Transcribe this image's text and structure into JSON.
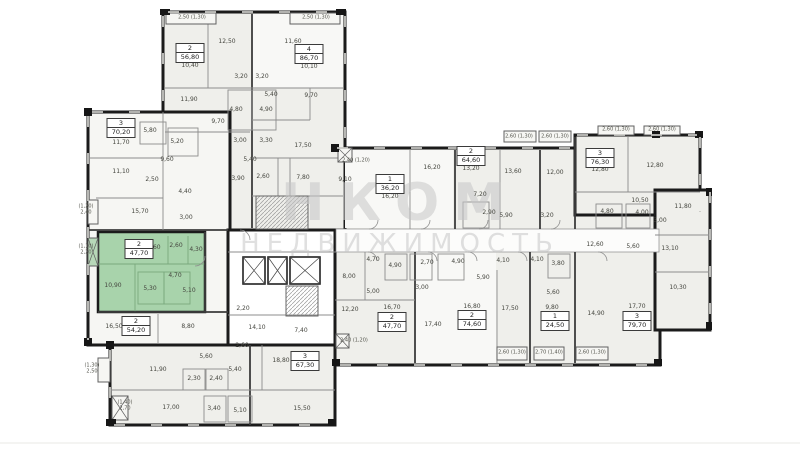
{
  "watermark": {
    "line1": "НКОМ",
    "line2": "НЕДВИЖИМОСТЬ"
  },
  "highlight_color": "#a8d3ab",
  "apartments": [
    {
      "t": "2",
      "a": "56,80",
      "x": 190,
      "y": 53
    },
    {
      "t": "4",
      "a": "86,70",
      "x": 309,
      "y": 54
    },
    {
      "t": "3",
      "a": "70,20",
      "x": 121,
      "y": 128
    },
    {
      "t": "2",
      "a": "47,70",
      "x": 139,
      "y": 249,
      "hl": true
    },
    {
      "t": "2",
      "a": "54,20",
      "x": 136,
      "y": 326
    },
    {
      "t": "1",
      "a": "36,20",
      "x": 390,
      "y": 184
    },
    {
      "t": "2",
      "a": "64,60",
      "x": 471,
      "y": 156
    },
    {
      "t": "3",
      "a": "76,30",
      "x": 600,
      "y": 158
    },
    {
      "t": "2",
      "a": "47,70",
      "x": 392,
      "y": 322
    },
    {
      "t": "2",
      "a": "74,60",
      "x": 472,
      "y": 320
    },
    {
      "t": "1",
      "a": "24,50",
      "x": 555,
      "y": 321
    },
    {
      "t": "3",
      "a": "79,70",
      "x": 637,
      "y": 321
    },
    {
      "t": "3",
      "a": "67,30",
      "x": 305,
      "y": 361
    }
  ],
  "rooms": [
    {
      "v": "12,50",
      "x": 227,
      "y": 42
    },
    {
      "v": "11,60",
      "x": 293,
      "y": 42
    },
    {
      "v": "10,40",
      "x": 190,
      "y": 66
    },
    {
      "v": "10,10",
      "x": 309,
      "y": 67
    },
    {
      "v": "3,20",
      "x": 241,
      "y": 77
    },
    {
      "v": "3,20",
      "x": 262,
      "y": 77
    },
    {
      "v": "11,90",
      "x": 189,
      "y": 100
    },
    {
      "v": "4,80",
      "x": 236,
      "y": 110
    },
    {
      "v": "4,90",
      "x": 266,
      "y": 110
    },
    {
      "v": "5,40",
      "x": 271,
      "y": 95
    },
    {
      "v": "9,70",
      "x": 311,
      "y": 96
    },
    {
      "v": "9,70",
      "x": 218,
      "y": 122
    },
    {
      "v": "3,00",
      "x": 240,
      "y": 141
    },
    {
      "v": "3,30",
      "x": 266,
      "y": 141
    },
    {
      "v": "17,50",
      "x": 303,
      "y": 146
    },
    {
      "v": "5,80",
      "x": 150,
      "y": 131
    },
    {
      "v": "5,20",
      "x": 177,
      "y": 142
    },
    {
      "v": "11,70",
      "x": 121,
      "y": 143
    },
    {
      "v": "9,60",
      "x": 167,
      "y": 160
    },
    {
      "v": "5,40",
      "x": 250,
      "y": 160
    },
    {
      "v": "11,10",
      "x": 121,
      "y": 172
    },
    {
      "v": "2,50",
      "x": 152,
      "y": 180
    },
    {
      "v": "3,90",
      "x": 238,
      "y": 179
    },
    {
      "v": "2,60",
      "x": 263,
      "y": 177
    },
    {
      "v": "7,80",
      "x": 303,
      "y": 178
    },
    {
      "v": "4,40",
      "x": 185,
      "y": 192
    },
    {
      "v": "15,70",
      "x": 140,
      "y": 212
    },
    {
      "v": "3,00",
      "x": 186,
      "y": 218
    },
    {
      "v": "13,60",
      "x": 152,
      "y": 248
    },
    {
      "v": "2,60",
      "x": 176,
      "y": 246
    },
    {
      "v": "4,30",
      "x": 196,
      "y": 250
    },
    {
      "v": "10,90",
      "x": 113,
      "y": 286
    },
    {
      "v": "5,30",
      "x": 150,
      "y": 289
    },
    {
      "v": "5,10",
      "x": 189,
      "y": 291
    },
    {
      "v": "4,70",
      "x": 175,
      "y": 276
    },
    {
      "v": "16,50",
      "x": 114,
      "y": 327
    },
    {
      "v": "8,80",
      "x": 188,
      "y": 327
    },
    {
      "v": "2,20",
      "x": 243,
      "y": 309
    },
    {
      "v": "14,10",
      "x": 257,
      "y": 328
    },
    {
      "v": "7,40",
      "x": 301,
      "y": 331
    },
    {
      "v": "18,80",
      "x": 281,
      "y": 361
    },
    {
      "v": "2,60",
      "x": 242,
      "y": 346
    },
    {
      "v": "5,60",
      "x": 206,
      "y": 357
    },
    {
      "v": "11,90",
      "x": 158,
      "y": 370
    },
    {
      "v": "2,30",
      "x": 194,
      "y": 379
    },
    {
      "v": "2,40",
      "x": 216,
      "y": 379
    },
    {
      "v": "5,40",
      "x": 235,
      "y": 370
    },
    {
      "v": "17,00",
      "x": 171,
      "y": 408
    },
    {
      "v": "3,40",
      "x": 214,
      "y": 409
    },
    {
      "v": "5,10",
      "x": 240,
      "y": 411
    },
    {
      "v": "15,50",
      "x": 302,
      "y": 409
    },
    {
      "v": "9,10",
      "x": 345,
      "y": 180
    },
    {
      "v": "16,20",
      "x": 390,
      "y": 197
    },
    {
      "v": "16,20",
      "x": 432,
      "y": 168
    },
    {
      "v": "13,20",
      "x": 471,
      "y": 169
    },
    {
      "v": "13,60",
      "x": 513,
      "y": 172
    },
    {
      "v": "12,00",
      "x": 555,
      "y": 173
    },
    {
      "v": "7,20",
      "x": 480,
      "y": 195
    },
    {
      "v": "2,90",
      "x": 489,
      "y": 213
    },
    {
      "v": "5,90",
      "x": 506,
      "y": 216
    },
    {
      "v": "3,20",
      "x": 547,
      "y": 216
    },
    {
      "v": "12,80",
      "x": 600,
      "y": 170
    },
    {
      "v": "12,80",
      "x": 655,
      "y": 166
    },
    {
      "v": "10,50",
      "x": 640,
      "y": 201
    },
    {
      "v": "4,80",
      "x": 607,
      "y": 212
    },
    {
      "v": "4,00",
      "x": 642,
      "y": 213
    },
    {
      "v": "3,00",
      "x": 660,
      "y": 221
    },
    {
      "v": "11,80",
      "x": 683,
      "y": 207
    },
    {
      "v": "13,10",
      "x": 670,
      "y": 249
    },
    {
      "v": "10,30",
      "x": 678,
      "y": 288
    },
    {
      "v": "12,60",
      "x": 595,
      "y": 245
    },
    {
      "v": "5,60",
      "x": 633,
      "y": 247
    },
    {
      "v": "4,70",
      "x": 373,
      "y": 260
    },
    {
      "v": "4,90",
      "x": 395,
      "y": 266
    },
    {
      "v": "2,70",
      "x": 427,
      "y": 263
    },
    {
      "v": "4,90",
      "x": 458,
      "y": 262
    },
    {
      "v": "4,10",
      "x": 503,
      "y": 261
    },
    {
      "v": "4,10",
      "x": 537,
      "y": 260
    },
    {
      "v": "3,80",
      "x": 558,
      "y": 264
    },
    {
      "v": "8,00",
      "x": 349,
      "y": 277
    },
    {
      "v": "5,00",
      "x": 373,
      "y": 292
    },
    {
      "v": "3,00",
      "x": 422,
      "y": 288
    },
    {
      "v": "5,90",
      "x": 483,
      "y": 278
    },
    {
      "v": "5,60",
      "x": 553,
      "y": 293
    },
    {
      "v": "9,80",
      "x": 552,
      "y": 308
    },
    {
      "v": "12,20",
      "x": 350,
      "y": 310
    },
    {
      "v": "16,70",
      "x": 392,
      "y": 308
    },
    {
      "v": "17,40",
      "x": 433,
      "y": 325
    },
    {
      "v": "16,80",
      "x": 472,
      "y": 307
    },
    {
      "v": "17,50",
      "x": 510,
      "y": 309
    },
    {
      "v": "17,70",
      "x": 637,
      "y": 307
    },
    {
      "v": "14,90",
      "x": 596,
      "y": 314
    }
  ],
  "balconies": [
    {
      "v": "2,50 (1,30)",
      "x": 192,
      "y": 18
    },
    {
      "v": "2,50 (1,30)",
      "x": 316,
      "y": 18
    },
    {
      "v": "2,40 (1,20)",
      "x": 356,
      "y": 161
    },
    {
      "v": "2,60 (1,30)",
      "x": 519,
      "y": 137
    },
    {
      "v": "2,60 (1,30)",
      "x": 555,
      "y": 137
    },
    {
      "v": "2,60 (1,30)",
      "x": 616,
      "y": 130
    },
    {
      "v": "2,60 (1,30)",
      "x": 662,
      "y": 130
    },
    {
      "v": "2,40 (1,20)",
      "x": 354,
      "y": 341
    },
    {
      "v": "2,60 (1,30)",
      "x": 512,
      "y": 353
    },
    {
      "v": "2,70 (1,40)",
      "x": 549,
      "y": 353
    },
    {
      "v": "2,60 (1,30)",
      "x": 592,
      "y": 353
    },
    {
      "v": "(1,20)\n2,40",
      "x": 86,
      "y": 210
    },
    {
      "v": "(1,10)\n2,20",
      "x": 86,
      "y": 250
    },
    {
      "v": "(1,30)\n2,50",
      "x": 92,
      "y": 369
    },
    {
      "v": "(1,40)\n2,70",
      "x": 125,
      "y": 406
    }
  ]
}
